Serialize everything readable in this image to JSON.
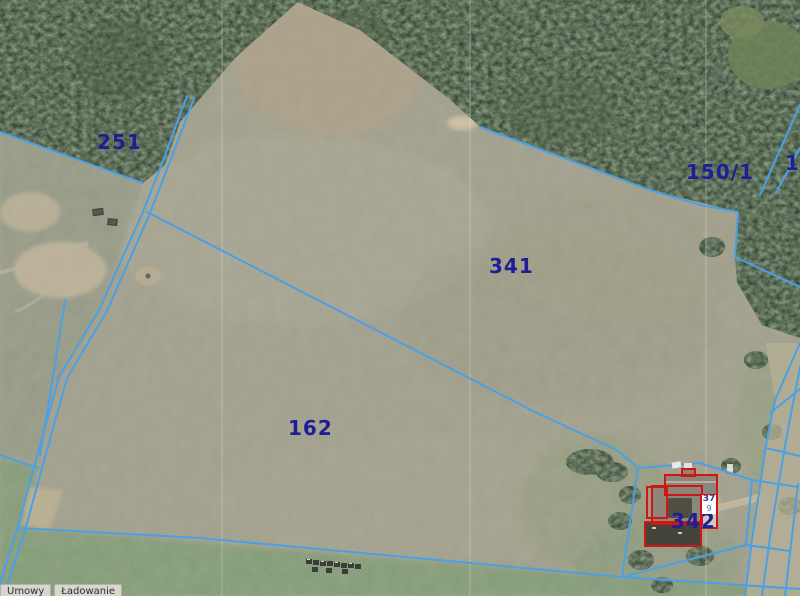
{
  "colors": {
    "parcel-line": "#4aa0e6",
    "parcel-label": "#1e1e96",
    "building-outline": "#d31414",
    "address-number": "#34349e",
    "address-secondary": "#3a6fd8",
    "status-bg": "#d7d7cf",
    "status-text": "#2f2f2f"
  },
  "map": {
    "type": "cadastral-orthophoto-viewer",
    "parcel_labels": {
      "p251": "251",
      "p150_1": "150/1",
      "p341": "341",
      "p162": "162",
      "p342": "342",
      "edge_partial": "1"
    },
    "address": {
      "primary": "37",
      "secondary": "9"
    },
    "status": {
      "left": "Umowy",
      "right": "Ładowanie"
    }
  }
}
